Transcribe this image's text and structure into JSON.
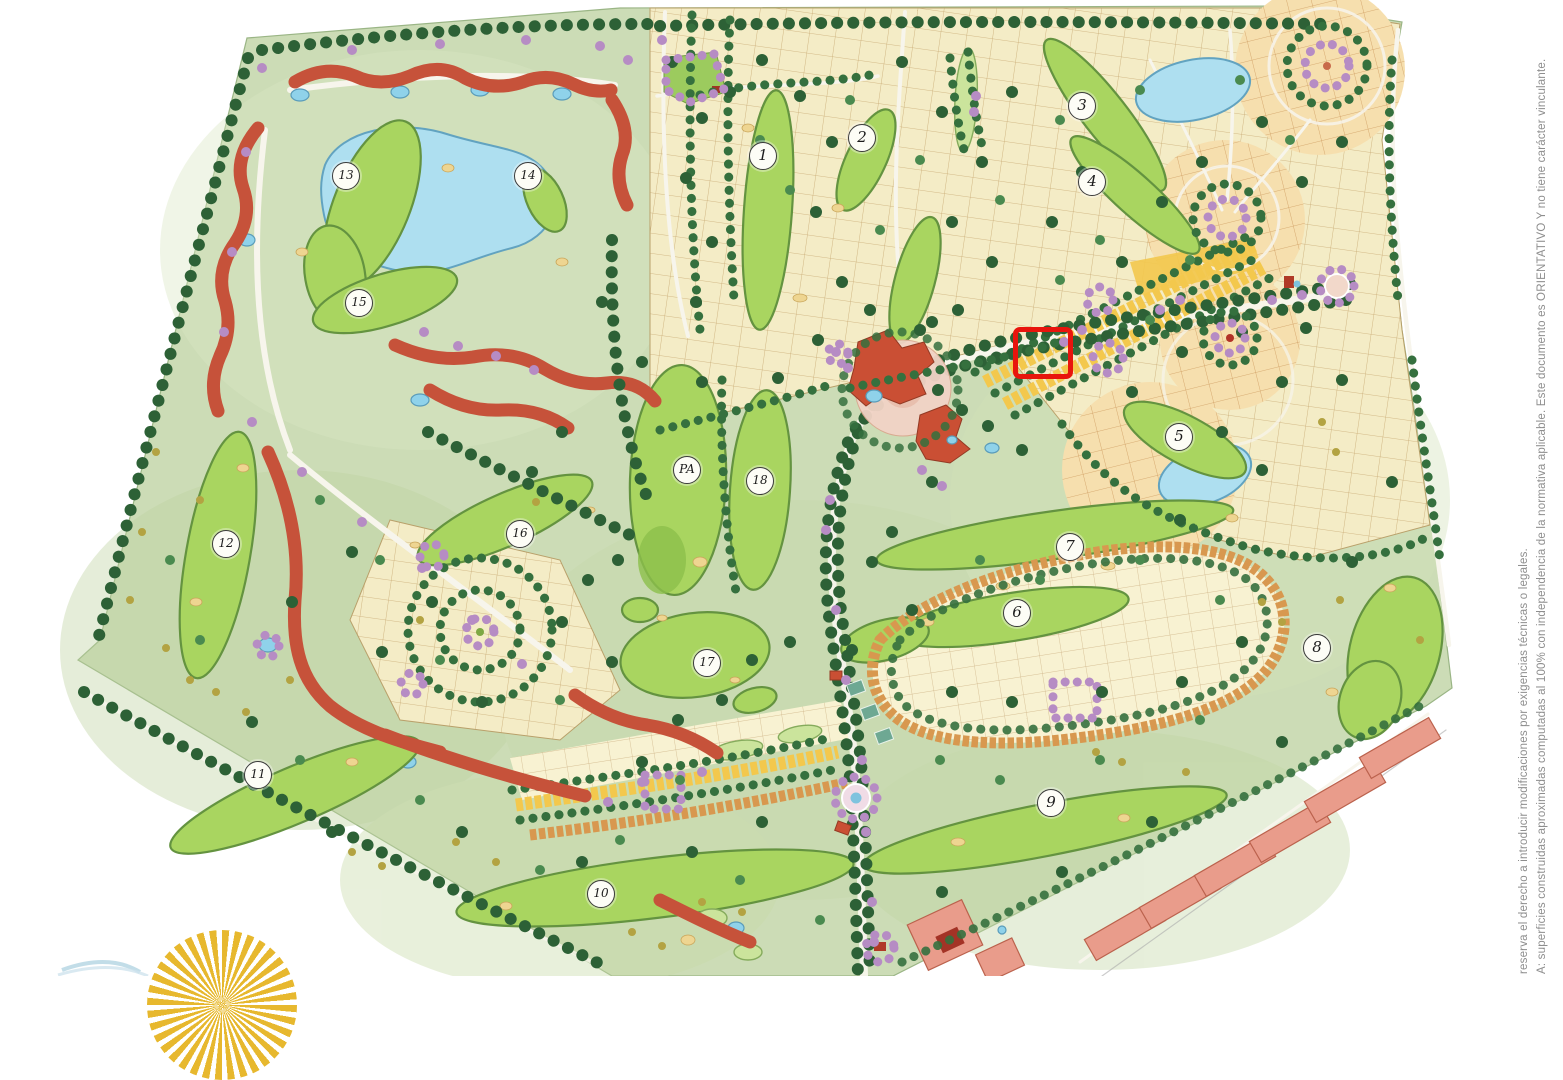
{
  "map_annotations": {
    "hole_markers": [
      {
        "label": "1",
        "x": 763,
        "y": 156
      },
      {
        "label": "2",
        "x": 862,
        "y": 138
      },
      {
        "label": "3",
        "x": 1082,
        "y": 106
      },
      {
        "label": "4",
        "x": 1092,
        "y": 182
      },
      {
        "label": "5",
        "x": 1179,
        "y": 437
      },
      {
        "label": "6",
        "x": 1017,
        "y": 613
      },
      {
        "label": "7",
        "x": 1070,
        "y": 547
      },
      {
        "label": "8",
        "x": 1317,
        "y": 648
      },
      {
        "label": "9",
        "x": 1051,
        "y": 803
      },
      {
        "label": "10",
        "x": 601,
        "y": 894
      },
      {
        "label": "11",
        "x": 258,
        "y": 775
      },
      {
        "label": "12",
        "x": 226,
        "y": 544
      },
      {
        "label": "13",
        "x": 346,
        "y": 176
      },
      {
        "label": "14",
        "x": 528,
        "y": 176
      },
      {
        "label": "15",
        "x": 359,
        "y": 303
      },
      {
        "label": "16",
        "x": 520,
        "y": 534
      },
      {
        "label": "17",
        "x": 707,
        "y": 663
      },
      {
        "label": "18",
        "x": 760,
        "y": 481
      },
      {
        "label": "PA",
        "x": 687,
        "y": 470
      }
    ],
    "highlight_box": {
      "x": 1013,
      "y": 327,
      "width": 50,
      "height": 42,
      "color": "#e8150d"
    }
  },
  "disclaimer": {
    "line1": "A: superficies construidas aproximadas computadas al 100% con independencia de la normativa aplicable.  Este documento es ORIENTATIVO Y  no tiene carácter vinculante.",
    "line2": "reserva el derecho a introducir modificaciones por exigencias  técnicas o legales."
  },
  "legend_colors": {
    "fairway_green": "#a9d560",
    "lake_blue": "#aedff0",
    "residential_plots": "#f5eec9",
    "townhouses_yellow": "#f3c84d",
    "townhouses_orange": "#d8984f",
    "condo_buildings_red": "#c6523a",
    "apartments_salmon": "#e99c8b",
    "trees_dark_green": "#2d6136",
    "ornamental_trees_purple": "#b68cc4",
    "highlight_red": "#e8150d",
    "sun_logo_yellow": "#e7b82e"
  }
}
